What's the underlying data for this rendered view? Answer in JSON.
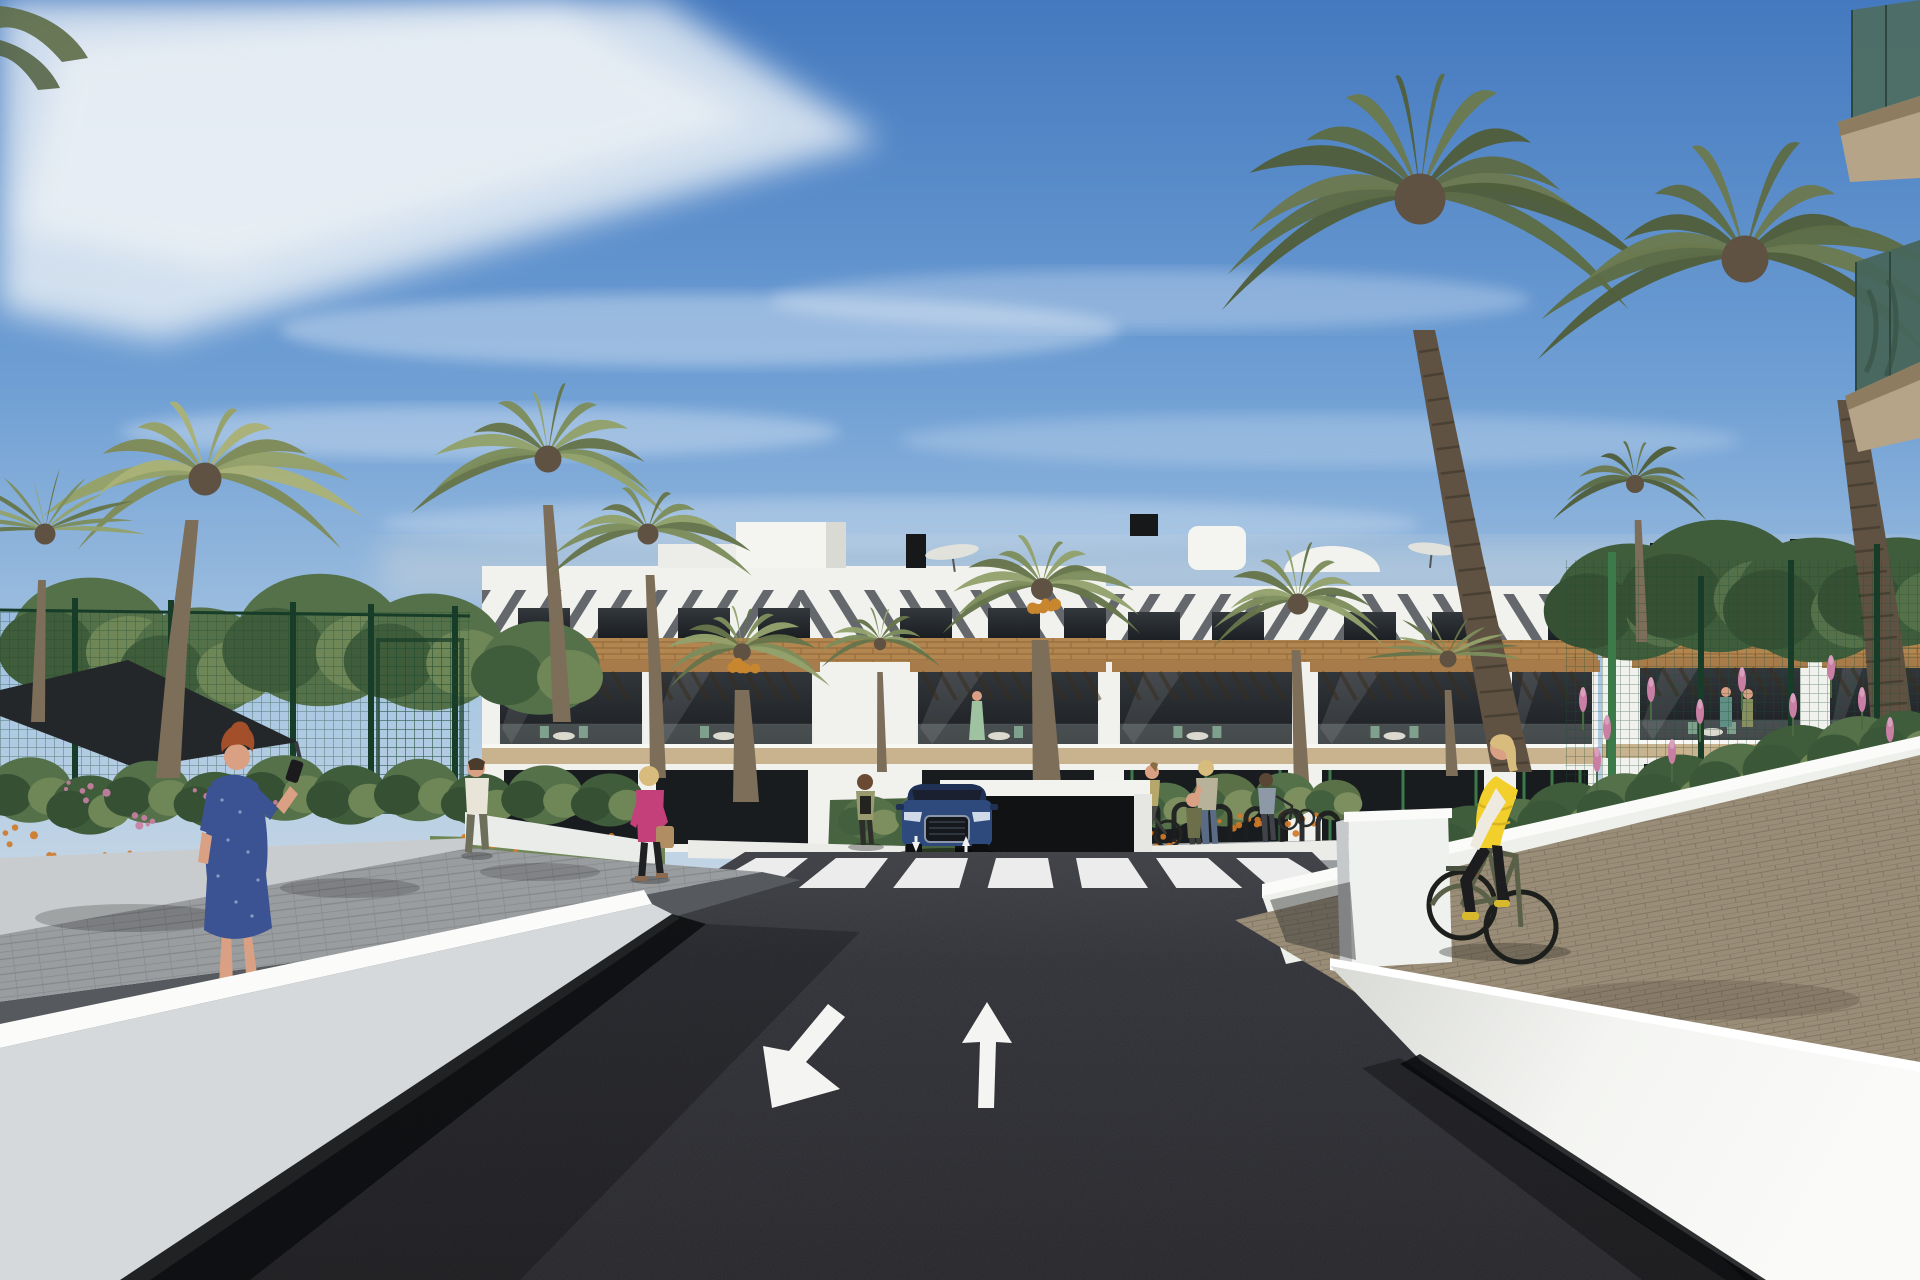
{
  "scene": {
    "description": "Sunny 3D architectural rendering of a modern white Mediterranean apartment complex seen from an access road. A dark asphalt road with two painted lane arrows leads to a zebra crosswalk and an underground-garage ramp where a dark blue SUV is exiting. White retaining walls flank the road; palm trees, green mesh fences and flowering gardens surround the buildings. Pedestrians walk on the side paths and a woman in a yellow vest cycles on a brick path at the right.",
    "road_markings": {
      "crosswalk_stripe_count": 7,
      "lane_arrow_left": "diagonal arrow pointing down-left (oncoming lane)",
      "lane_arrow_right": "straight arrow pointing up (ahead lane)",
      "ramp_arrows": "two small white up/down arrows at garage ramp"
    },
    "vehicle": {
      "type": "suv-front-view",
      "body_color": "#2e4a7d"
    },
    "people": [
      {
        "id": "pedestrian-blue-dress",
        "desc": "red-haired woman in blue patterned dress on phone, seen from behind"
      },
      {
        "id": "pedestrian-pink-jacket",
        "desc": "blonde woman, magenta jacket, black trousers, tan handbag"
      },
      {
        "id": "pedestrian-man-white-shirt",
        "desc": "man in white t-shirt and olive trousers walking away"
      },
      {
        "id": "pedestrian-olive-jacket",
        "desc": "woman in olive jacket standing near crosswalk"
      },
      {
        "id": "mother-and-child",
        "desc": "mother in floral top with small child in olive jacket"
      },
      {
        "id": "sidewalk-cyclist",
        "desc": "small cyclist on garden path"
      },
      {
        "id": "stroller-woman",
        "desc": "woman pushing a bike/stroller behind wall"
      },
      {
        "id": "main-cyclist",
        "desc": "blonde woman in yellow puffer vest on olive bicycle"
      },
      {
        "id": "balcony-residents",
        "desc": "tiny figures on balconies"
      }
    ],
    "buildings": [
      {
        "id": "building-center-left",
        "x0": 482,
        "x1": 1106,
        "parapet": 566,
        "louv": [
          590,
          638
        ],
        "wood": [
          638,
          662
        ],
        "balc": [
          662,
          752
        ],
        "slab": [
          748,
          764
        ],
        "ground": [
          764,
          852
        ],
        "split": 800,
        "windows": [
          518,
          598,
          678,
          758,
          900,
          988,
          1064
        ],
        "winY": 608,
        "modules": [
          {
            "x": 500,
            "w": 142
          },
          {
            "x": 652,
            "w": 160
          },
          {
            "x": 918,
            "w": 180
          }
        ]
      },
      {
        "id": "building-center-right",
        "x0": 1106,
        "x1": 1598,
        "parapet": 586,
        "louv": [
          594,
          640
        ],
        "wood": [
          640,
          662
        ],
        "balc": [
          662,
          752
        ],
        "slab": [
          748,
          764
        ],
        "ground": [
          764,
          852
        ],
        "split": 1350,
        "greenFrames": true,
        "windows": [
          1128,
          1212,
          1344,
          1432,
          1548
        ],
        "winY": 612,
        "modules": [
          {
            "x": 1120,
            "w": 172
          },
          {
            "x": 1318,
            "w": 170
          },
          {
            "x": 1512,
            "w": 80
          }
        ]
      },
      {
        "id": "building-right",
        "x0": 1602,
        "x1": 1920,
        "parapet": 590,
        "louv": [
          596,
          636
        ],
        "wood": [
          636,
          658
        ],
        "balc": [
          658,
          748
        ],
        "slab": [
          744,
          758
        ],
        "ground": [
          758,
          840
        ],
        "split": 1770,
        "windows": [
          1628,
          1742,
          1852
        ],
        "winY": 614,
        "modules": [
          {
            "x": 1640,
            "w": 160
          },
          {
            "x": 1830,
            "w": 90
          }
        ]
      }
    ],
    "palms": [
      {
        "id": "palm-left-large",
        "cx": 205,
        "cy": 475,
        "r": 165,
        "fronds": 13,
        "tone": "light",
        "tw": 24,
        "trunk": [
          [
            192,
            520
          ],
          [
            178,
            645
          ],
          [
            168,
            778
          ]
        ]
      },
      {
        "id": "palm-left-fan",
        "cx": 45,
        "cy": 530,
        "r": 105,
        "fronds": 12,
        "fan": true,
        "tw": 14,
        "trunk": [
          [
            42,
            580
          ],
          [
            40,
            650
          ],
          [
            38,
            722
          ]
        ]
      },
      {
        "id": "palm-mid-left",
        "cx": 548,
        "cy": 455,
        "r": 135,
        "fronds": 12,
        "tw": 18,
        "trunk": [
          [
            548,
            505
          ],
          [
            556,
            615
          ],
          [
            562,
            722
          ]
        ]
      },
      {
        "id": "palm-front-left",
        "cx": 648,
        "cy": 530,
        "r": 105,
        "fronds": 11,
        "tw": 16,
        "trunk": [
          [
            650,
            575
          ],
          [
            655,
            672
          ],
          [
            658,
            778
          ]
        ]
      },
      {
        "id": "palm-date-left",
        "cx": 742,
        "cy": 648,
        "r": 88,
        "fronds": 12,
        "tw": 26,
        "fruit": true,
        "trunk": [
          [
            742,
            690
          ],
          [
            744,
            742
          ],
          [
            746,
            802
          ]
        ]
      },
      {
        "id": "palm-small-center",
        "cx": 880,
        "cy": 640,
        "r": 62,
        "fronds": 10,
        "tw": 10,
        "trunk": [
          [
            880,
            672
          ],
          [
            881,
            722
          ],
          [
            882,
            772
          ]
        ]
      },
      {
        "id": "palm-date-center",
        "cx": 1042,
        "cy": 585,
        "r": 110,
        "fronds": 13,
        "tw": 30,
        "fruit": true,
        "trunk": [
          [
            1040,
            640
          ],
          [
            1044,
            722
          ],
          [
            1048,
            806
          ]
        ]
      },
      {
        "id": "palm-right-mid",
        "cx": 1298,
        "cy": 600,
        "r": 105,
        "fronds": 12,
        "tw": 16,
        "trunk": [
          [
            1296,
            650
          ],
          [
            1299,
            722
          ],
          [
            1302,
            796
          ]
        ]
      },
      {
        "id": "palm-right-bg",
        "cx": 1635,
        "cy": 480,
        "r": 90,
        "fronds": 10,
        "tone": "dark",
        "tw": 12,
        "trunk": [
          [
            1638,
            520
          ],
          [
            1640,
            582
          ],
          [
            1642,
            642
          ]
        ]
      },
      {
        "id": "palm-tall-right",
        "cx": 1420,
        "cy": 195,
        "r": 255,
        "fronds": 14,
        "tone": "dark",
        "tw": 40,
        "rings": true,
        "trunk": [
          [
            1424,
            330
          ],
          [
            1468,
            560
          ],
          [
            1512,
            772
          ]
        ]
      },
      {
        "id": "palm-far-right",
        "cx": 1745,
        "cy": 255,
        "r": 235,
        "fronds": 13,
        "tone": "dark",
        "tw": 46,
        "rings": true,
        "trunk": [
          [
            1850,
            400
          ],
          [
            1880,
            610
          ],
          [
            1900,
            800
          ]
        ]
      },
      {
        "id": "palm-fan-right",
        "cx": 1448,
        "cy": 655,
        "r": 85,
        "fronds": 11,
        "fan": true,
        "tw": 12,
        "trunk": [
          [
            1448,
            690
          ],
          [
            1450,
            732
          ],
          [
            1452,
            776
          ]
        ]
      }
    ],
    "trees_left": [
      [
        90,
        640,
        80
      ],
      [
        200,
        662,
        70
      ],
      [
        320,
        640,
        85
      ],
      [
        430,
        652,
        75
      ],
      [
        540,
        668,
        60
      ]
    ],
    "trees_right": [
      [
        1630,
        602,
        75
      ],
      [
        1718,
        586,
        85
      ],
      [
        1815,
        600,
        80
      ],
      [
        1898,
        592,
        70
      ]
    ],
    "shrubs_left": [
      [
        30,
        790,
        42
      ],
      [
        90,
        805,
        38
      ],
      [
        150,
        792,
        40
      ],
      [
        215,
        800,
        36
      ],
      [
        285,
        788,
        42
      ],
      [
        350,
        795,
        38
      ],
      [
        420,
        790,
        40
      ],
      [
        480,
        800,
        34
      ],
      [
        545,
        795,
        38
      ],
      [
        610,
        800,
        34
      ]
    ],
    "shrubs_right": [
      [
        1470,
        840,
        44
      ],
      [
        1520,
        830,
        40
      ],
      [
        1570,
        818,
        46
      ],
      [
        1625,
        806,
        42
      ],
      [
        1680,
        792,
        48
      ],
      [
        1740,
        778,
        44
      ],
      [
        1800,
        764,
        50
      ],
      [
        1860,
        752,
        46
      ],
      [
        1905,
        742,
        40
      ]
    ],
    "shrubs_center": [
      [
        1050,
        822,
        30
      ],
      [
        1105,
        812,
        34
      ],
      [
        1165,
        806,
        30
      ],
      [
        1225,
        800,
        34
      ],
      [
        1285,
        796,
        30
      ],
      [
        1335,
        800,
        26
      ],
      [
        870,
        818,
        28
      ],
      [
        930,
        812,
        30
      ],
      [
        985,
        818,
        26
      ]
    ],
    "flowers_orange_left": [
      [
        12,
        832,
        6,
        26
      ],
      [
        58,
        856,
        7,
        24
      ],
      [
        118,
        860,
        6,
        22
      ],
      [
        480,
        846,
        6,
        20
      ],
      [
        530,
        862,
        7,
        22
      ],
      [
        596,
        842,
        5,
        18
      ],
      [
        640,
        854,
        5,
        16
      ]
    ],
    "flowers_pink_left": [
      [
        88,
        790,
        6,
        22
      ],
      [
        142,
        816,
        5,
        20
      ],
      [
        208,
        796,
        6,
        22
      ],
      [
        262,
        810,
        5,
        18
      ]
    ],
    "flowers_orange_center": [
      [
        1090,
        840,
        8,
        26
      ],
      [
        1160,
        834,
        8,
        28
      ],
      [
        1235,
        828,
        8,
        26
      ],
      [
        1300,
        824,
        7,
        22
      ],
      [
        1020,
        846,
        6,
        20
      ]
    ],
    "lupines_right": [
      [
        1583,
        700
      ],
      [
        1607,
        728
      ],
      [
        1651,
        690
      ],
      [
        1700,
        712
      ],
      [
        1742,
        680
      ],
      [
        1793,
        706
      ],
      [
        1831,
        668
      ],
      [
        1597,
        760
      ],
      [
        1672,
        752
      ],
      [
        1862,
        700
      ],
      [
        1890,
        730
      ]
    ],
    "bike_rack_count": 6,
    "crosswalk": {
      "n": 7,
      "xStart": 756,
      "pitch": 80,
      "wTop": 52,
      "yTop": 858,
      "yBot": 888,
      "cx": 1030,
      "spread": 1.18
    }
  },
  "colors": {
    "sky_top": "#4479bf",
    "sky_mid": "#6f9fd4",
    "sky_low": "#a9c6e2",
    "sky_horizon": "#c9d9e6",
    "cloud": "#f0f4f7",
    "building_white": "#f1f2ee",
    "building_shade": "#dadbd5",
    "louver_shadow": "#3c4148",
    "window_dark": "#23272b",
    "wood_band": "#b3854f",
    "wood_line": "#8a6238",
    "pergola_wood": "#a87c4a",
    "balcony_slab": "#c9b28e",
    "glass_teal": "#4e6e63",
    "fence_green": "#1f4d33",
    "fence_post": "#173c28",
    "fence_bright": "#3d7a4a",
    "foliage_dark": "#3f5c3b",
    "foliage_mid": "#54714a",
    "foliage_light": "#6f8657",
    "palm_dark": "#66754a",
    "palm_mid": "#7d8d5c",
    "palm_light": "#93a26c",
    "palm_deep1": "#4f5e3c",
    "palm_deep2": "#5d6c46",
    "palm_deep3": "#6b7a50",
    "palm_sun1": "#7f8a57",
    "palm_sun2": "#96a168",
    "palm_sun3": "#aab277",
    "trunk": "#7d6e59",
    "trunk_dark": "#5f5242",
    "flower_orange": "#d07a28",
    "flower_pink": "#c97fa4",
    "road": "#26262a",
    "road_light": "#3c3e44",
    "marking_white": "#f4f4f2",
    "wall_white": "#f3f4f1",
    "wall_gray": "#c9ccce",
    "wall_face": "#d6d9db",
    "sidewalk": "#9a9da0",
    "paver_dark": "#565a5e",
    "brick_path": "#9a8d77",
    "brick_line": "#6f6253",
    "shadow": "#0c0d0f",
    "car_body": "#2e4a7d",
    "car_roof": "#1f3154",
    "car_glass": "#1a2030",
    "car_grille": "#15181c",
    "shade_sail": "#23272a",
    "skin": "#d9a083",
    "dress_blue": "#3b5393",
    "jacket_pink": "#c4407a",
    "vest_yellow": "#f2cf2a",
    "hair_auburn": "#a34f2a",
    "hair_blonde": "#d8bc7d",
    "bike_olive": "#5a6148",
    "umbrella_white": "#e2e2dc",
    "chimney_black": "#16181a"
  }
}
